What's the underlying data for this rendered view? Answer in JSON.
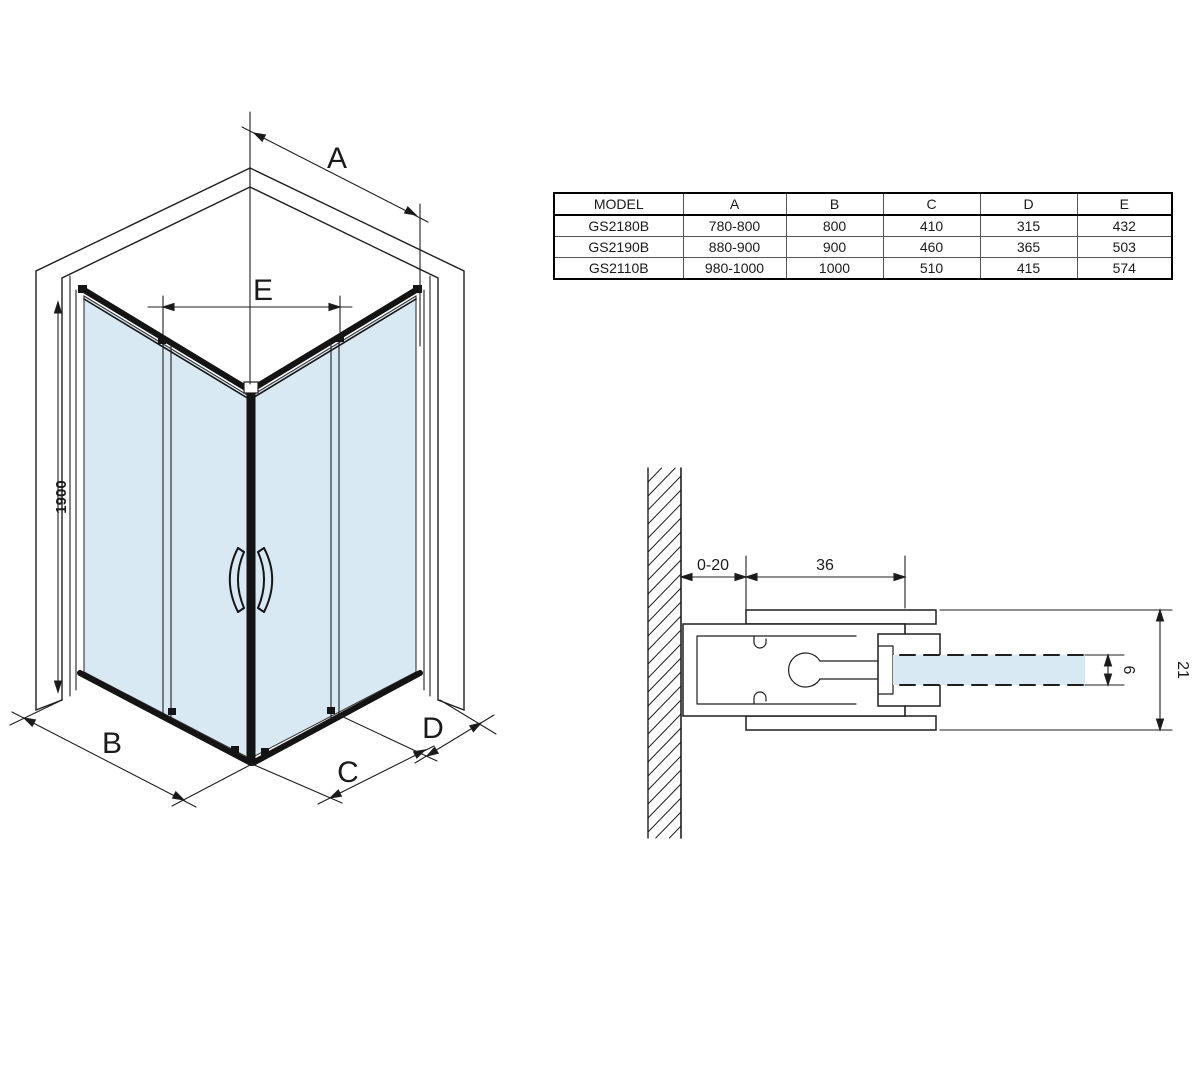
{
  "figure": {
    "type": "shower-enclosure-technical-drawing"
  },
  "dimensions_table": {
    "columns": [
      "MODEL",
      "A",
      "B",
      "C",
      "D",
      "E"
    ],
    "rows": [
      [
        "GS2180B",
        "780-800",
        "800",
        "410",
        "315",
        "432"
      ],
      [
        "GS2190B",
        "880-900",
        "900",
        "460",
        "365",
        "503"
      ],
      [
        "GS2110B",
        "980-1000",
        "1000",
        "510",
        "415",
        "574"
      ]
    ]
  },
  "isometric_view": {
    "dim_labels": {
      "a": "A",
      "b": "B",
      "c": "C",
      "d": "D",
      "e": "E"
    },
    "height_label": "1900"
  },
  "section_view": {
    "wall_offset": "0-20",
    "profile_width": "36",
    "glass_thickness": "6",
    "profile_depth": "21"
  },
  "colors": {
    "glass": "#d9e9f3",
    "outline": "#1f1f1f",
    "frame": "#141414"
  }
}
